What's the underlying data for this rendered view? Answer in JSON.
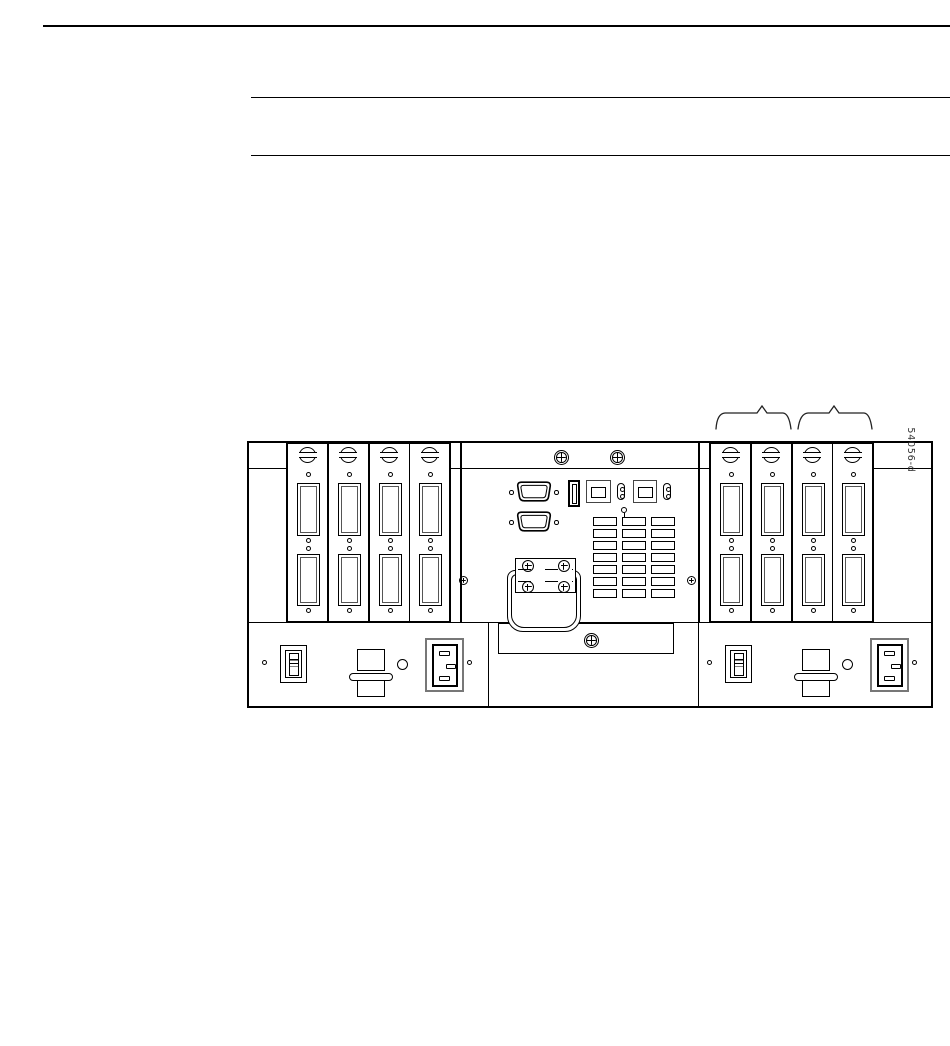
{
  "figure": {
    "artwork_id": "54056-d",
    "background": "#ffffff",
    "line_color": "#000000",
    "left_card_slots": 4,
    "right_card_slots": 4,
    "connectors_per_card": 2,
    "power_supplies": 2,
    "brace_annotations": 2,
    "vent_columns": 3,
    "vent_rows": 7
  }
}
